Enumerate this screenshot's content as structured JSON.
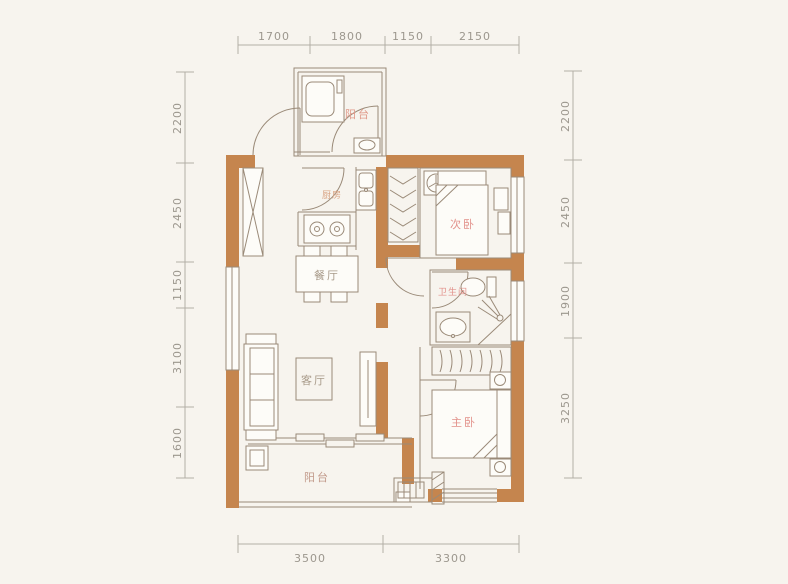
{
  "canvas": {
    "width": 788,
    "height": 584
  },
  "colors": {
    "background": "#f7f4ee",
    "wall": "#c5854e",
    "line": "#9a8a78",
    "dim_line": "#b3afa6",
    "dim_text": "#9c978e"
  },
  "rooms": [
    {
      "id": "balcony-top",
      "label": "阳台",
      "color": "#e09a8a"
    },
    {
      "id": "kitchen",
      "label": "厨房",
      "color": "#d9a383"
    },
    {
      "id": "second-bedroom",
      "label": "次卧",
      "color": "#e2908a"
    },
    {
      "id": "dining-room",
      "label": "餐厅",
      "color": "#a89a89"
    },
    {
      "id": "bathroom",
      "label": "卫生间",
      "color": "#e2908a"
    },
    {
      "id": "living-room",
      "label": "客厅",
      "color": "#a89a89"
    },
    {
      "id": "master-bedroom",
      "label": "主卧",
      "color": "#e2908a"
    },
    {
      "id": "balcony-bottom",
      "label": "阳台",
      "color": "#c29a8b"
    }
  ],
  "dimensions": {
    "top": [
      "1700",
      "1800",
      "1150",
      "2150"
    ],
    "bottom": [
      "3500",
      "3300"
    ],
    "left": [
      "2200",
      "2450",
      "1150",
      "3100",
      "1600"
    ],
    "right": [
      "2200",
      "2450",
      "1900",
      "3250"
    ]
  }
}
